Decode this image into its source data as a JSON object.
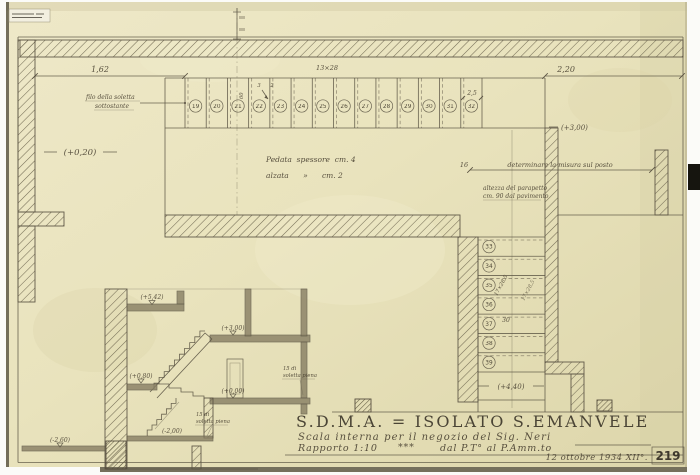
{
  "plan": {
    "dim_left": "1,62",
    "dim_right": "2,20",
    "dim_treads": "13×28",
    "dim_step_a": "3",
    "dim_step_b": "2",
    "dim_width": "60",
    "dim_nosing": "2,5",
    "dim_sixteen": "16",
    "dim_thirty": "30",
    "dim_riser_tread": "17×28,5",
    "level_start": "(+0,20)",
    "level_landing": "(+3,00)",
    "level_arrival": "(+4,40)",
    "note_filo_line1": "filo della soletta",
    "note_filo_line2": "sottostante",
    "note_pedata": "Pedata  spessore  cm. 4",
    "note_alzata": "alzata      »      cm. 2",
    "note_misura": "determinare la misura sul posto",
    "note_parapetto_line1": "altezza del parapetto",
    "note_parapetto_line2": "cm. 90 dal pavimento",
    "treads_top": [
      "19",
      "20",
      "21",
      "22",
      "23",
      "24",
      "25",
      "26",
      "27",
      "28",
      "29",
      "30",
      "31",
      "32"
    ],
    "treads_right": [
      "33",
      "34",
      "35",
      "36",
      "37",
      "38",
      "39"
    ]
  },
  "section": {
    "level_top": "(+5,42)",
    "level_mezzanine": "(+3,00)",
    "level_landing": "(+0,80)",
    "level_ground": "(+0,00)",
    "level_basement_mid": "(-2,00)",
    "level_basement_low": "(-2,60)",
    "note_slab_a_line1": "15 di",
    "note_slab_a_line2": "soletta piena",
    "note_slab_b_line1": "15 di",
    "note_slab_b_line2": "soletta piena"
  },
  "title_block": {
    "title": "S.D.M.A. = ISOLATO S.EMANVELE",
    "subtitle": "Scala interna per il negozio del Sig. Neri",
    "scale": "Rapporto 1:10",
    "scale_marks": "***",
    "range": "dal P.T° al P.Amm.to",
    "date": "12 ottobre 1934 XII°.",
    "sheet_number": "219"
  }
}
